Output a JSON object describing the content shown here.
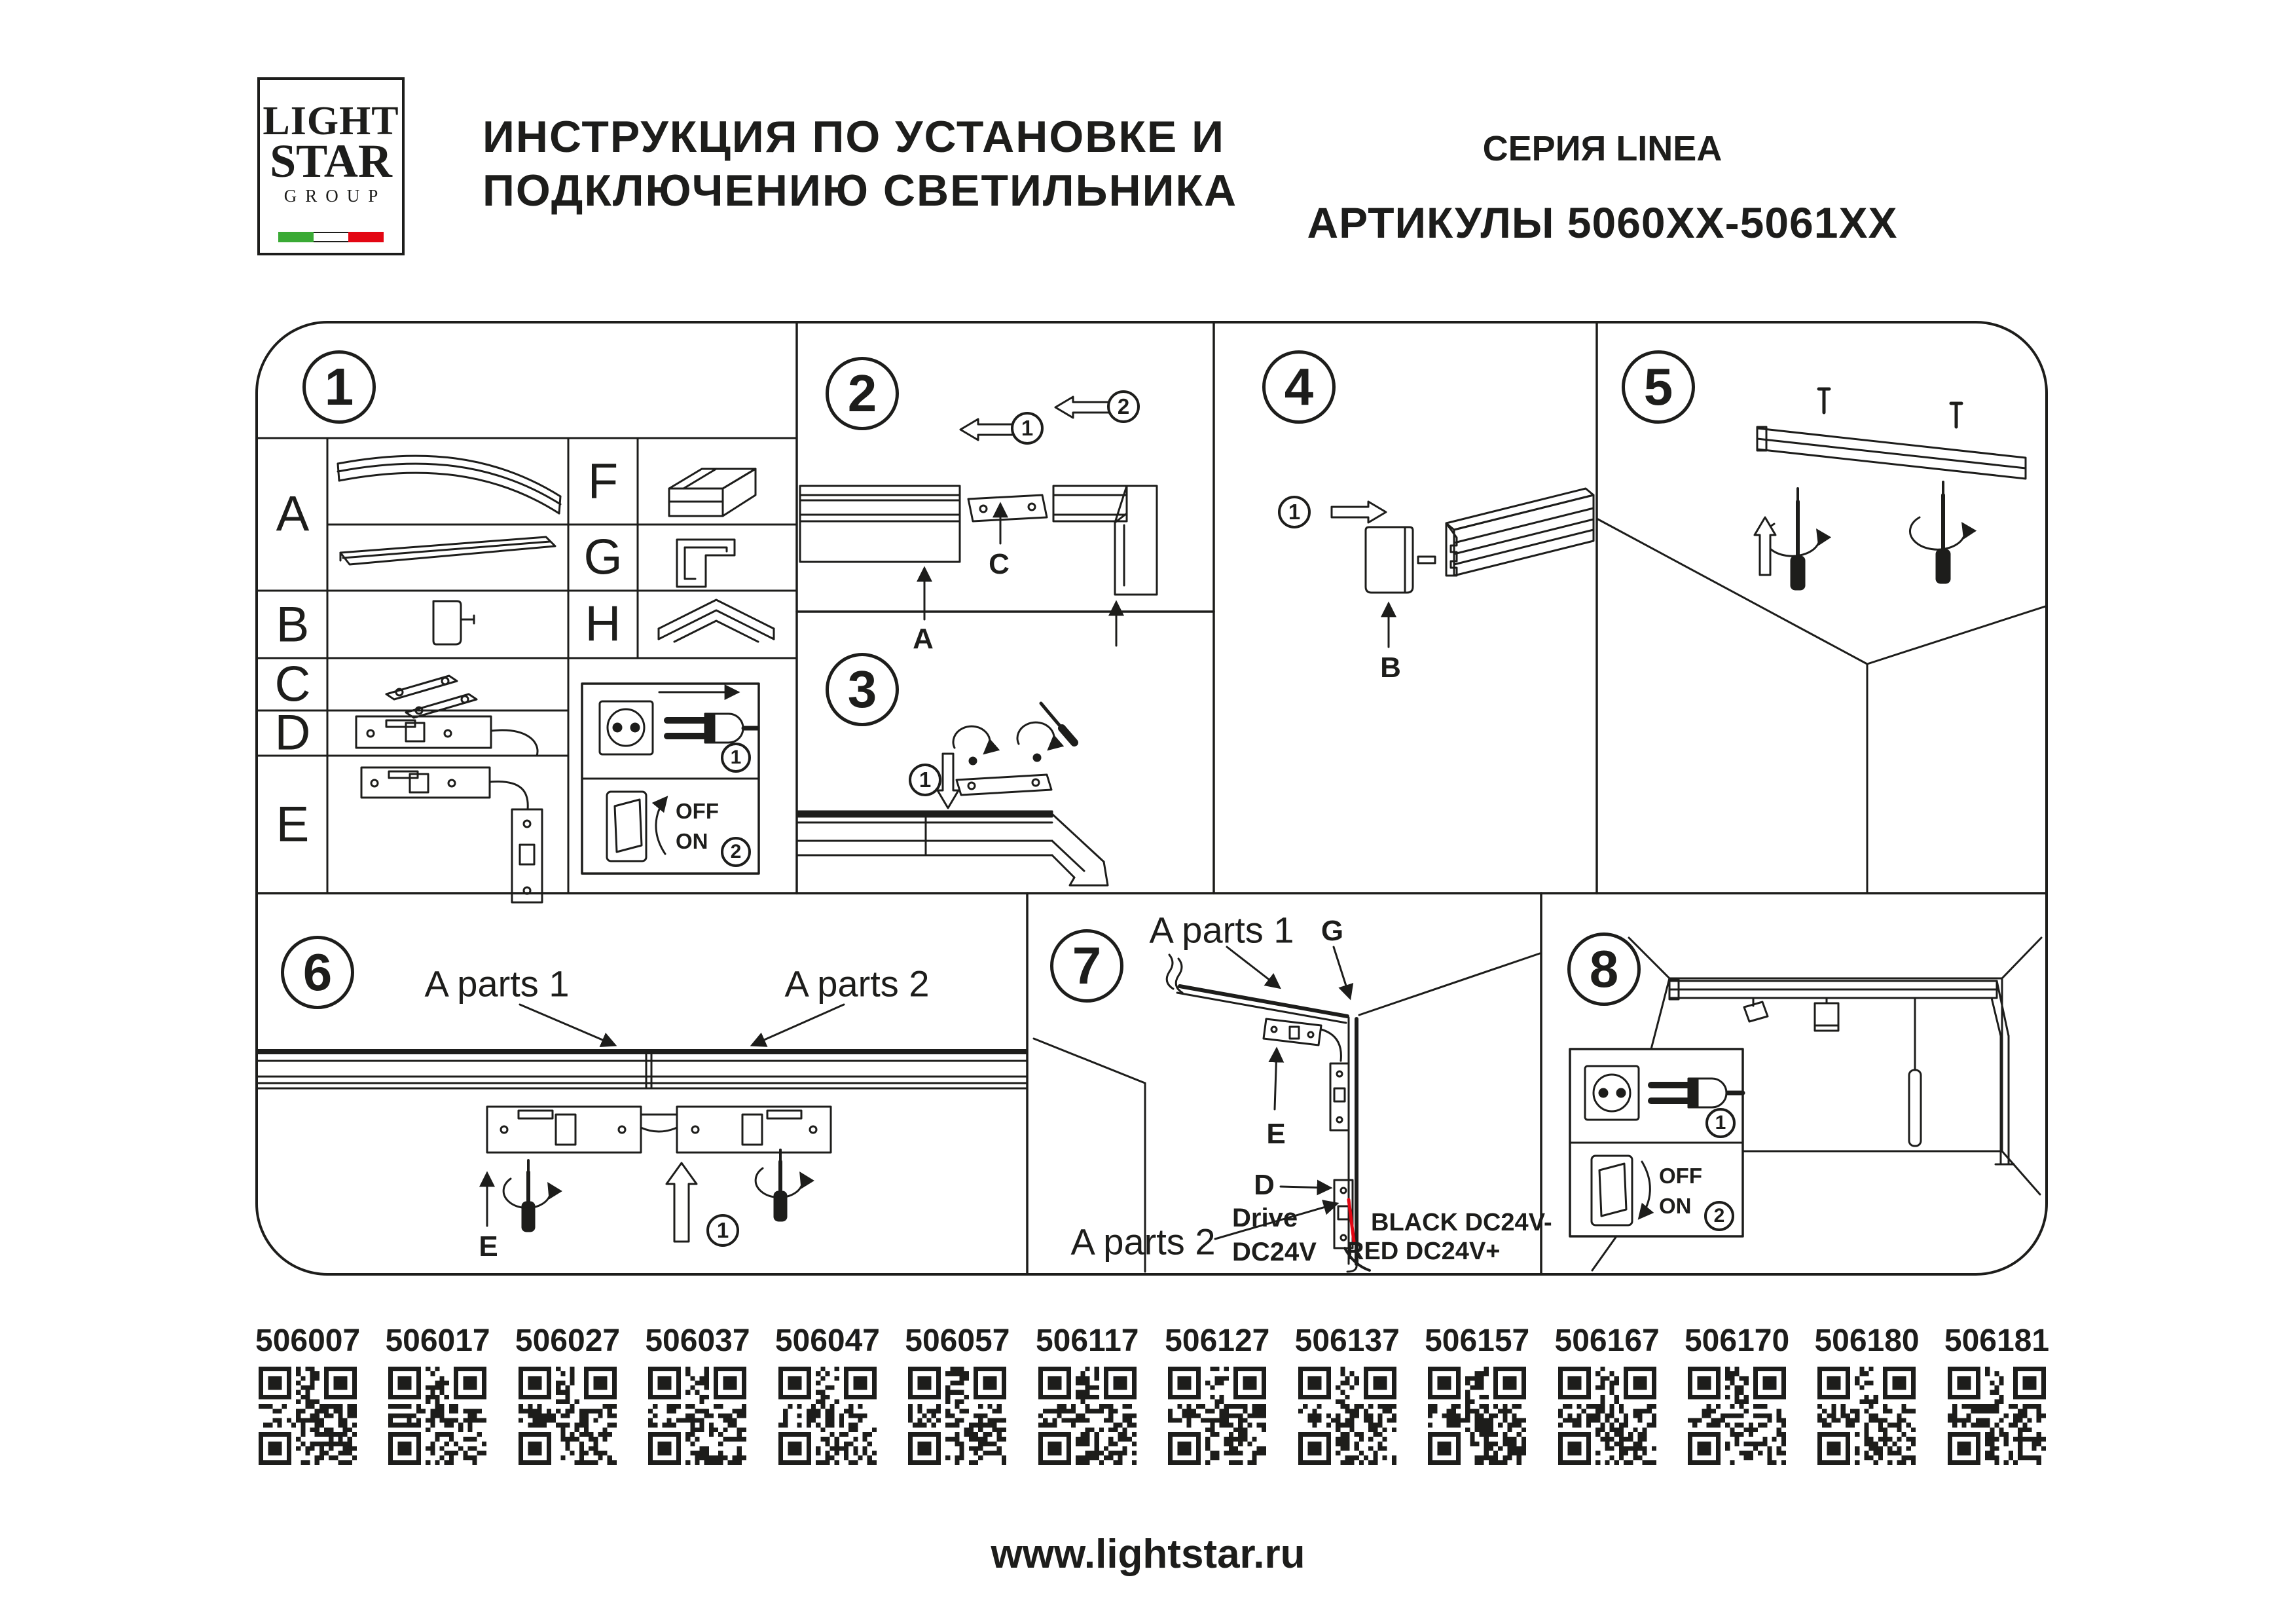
{
  "header": {
    "logo": {
      "line1": "LIGHT",
      "line2": "STAR",
      "line3": "GROUP"
    },
    "title_line1": "ИНСТРУКЦИЯ ПО УСТАНОВКЕ И",
    "title_line2": "ПОДКЛЮЧЕНИЮ СВЕТИЛЬНИКА",
    "series": "СЕРИЯ LINEA",
    "articles": "АРТИКУЛЫ 5060XX-5061XX"
  },
  "colors": {
    "ink": "#1d1d1b",
    "red": "#e30613",
    "flag_green": "#3aaa35",
    "flag_red": "#e30613"
  },
  "steps": {
    "s1": "1",
    "s2": "2",
    "s3": "3",
    "s4": "4",
    "s5": "5",
    "s6": "6",
    "s7": "7",
    "s8": "8"
  },
  "markers": {
    "one": "1",
    "two": "2"
  },
  "parts_table": {
    "row_a": "A",
    "row_b": "B",
    "row_c": "C",
    "row_d": "D",
    "row_e": "E",
    "row_f": "F",
    "row_g": "G",
    "row_h": "H"
  },
  "power_legend": {
    "off": "OFF",
    "on": "ON"
  },
  "step2": {
    "label_a": "A",
    "label_c": "C"
  },
  "step4": {
    "label_b": "B"
  },
  "step6": {
    "a_parts_1": "A parts 1",
    "a_parts_2": "A parts 2",
    "label_e": "E"
  },
  "step7": {
    "a_parts_1": "A parts 1",
    "a_parts_2": "A parts 2",
    "label_g": "G",
    "label_e": "E",
    "label_d": "D",
    "drive1": "Drive",
    "drive2": "DC24V",
    "wire_black": "BLACK DC24V-",
    "wire_red": "RED DC24V+"
  },
  "qr_codes": [
    "506007",
    "506017",
    "506027",
    "506037",
    "506047",
    "506057",
    "506117",
    "506127",
    "506137",
    "506157",
    "506167",
    "506170",
    "506180",
    "506181"
  ],
  "footer": {
    "website": "www.lightstar.ru"
  }
}
